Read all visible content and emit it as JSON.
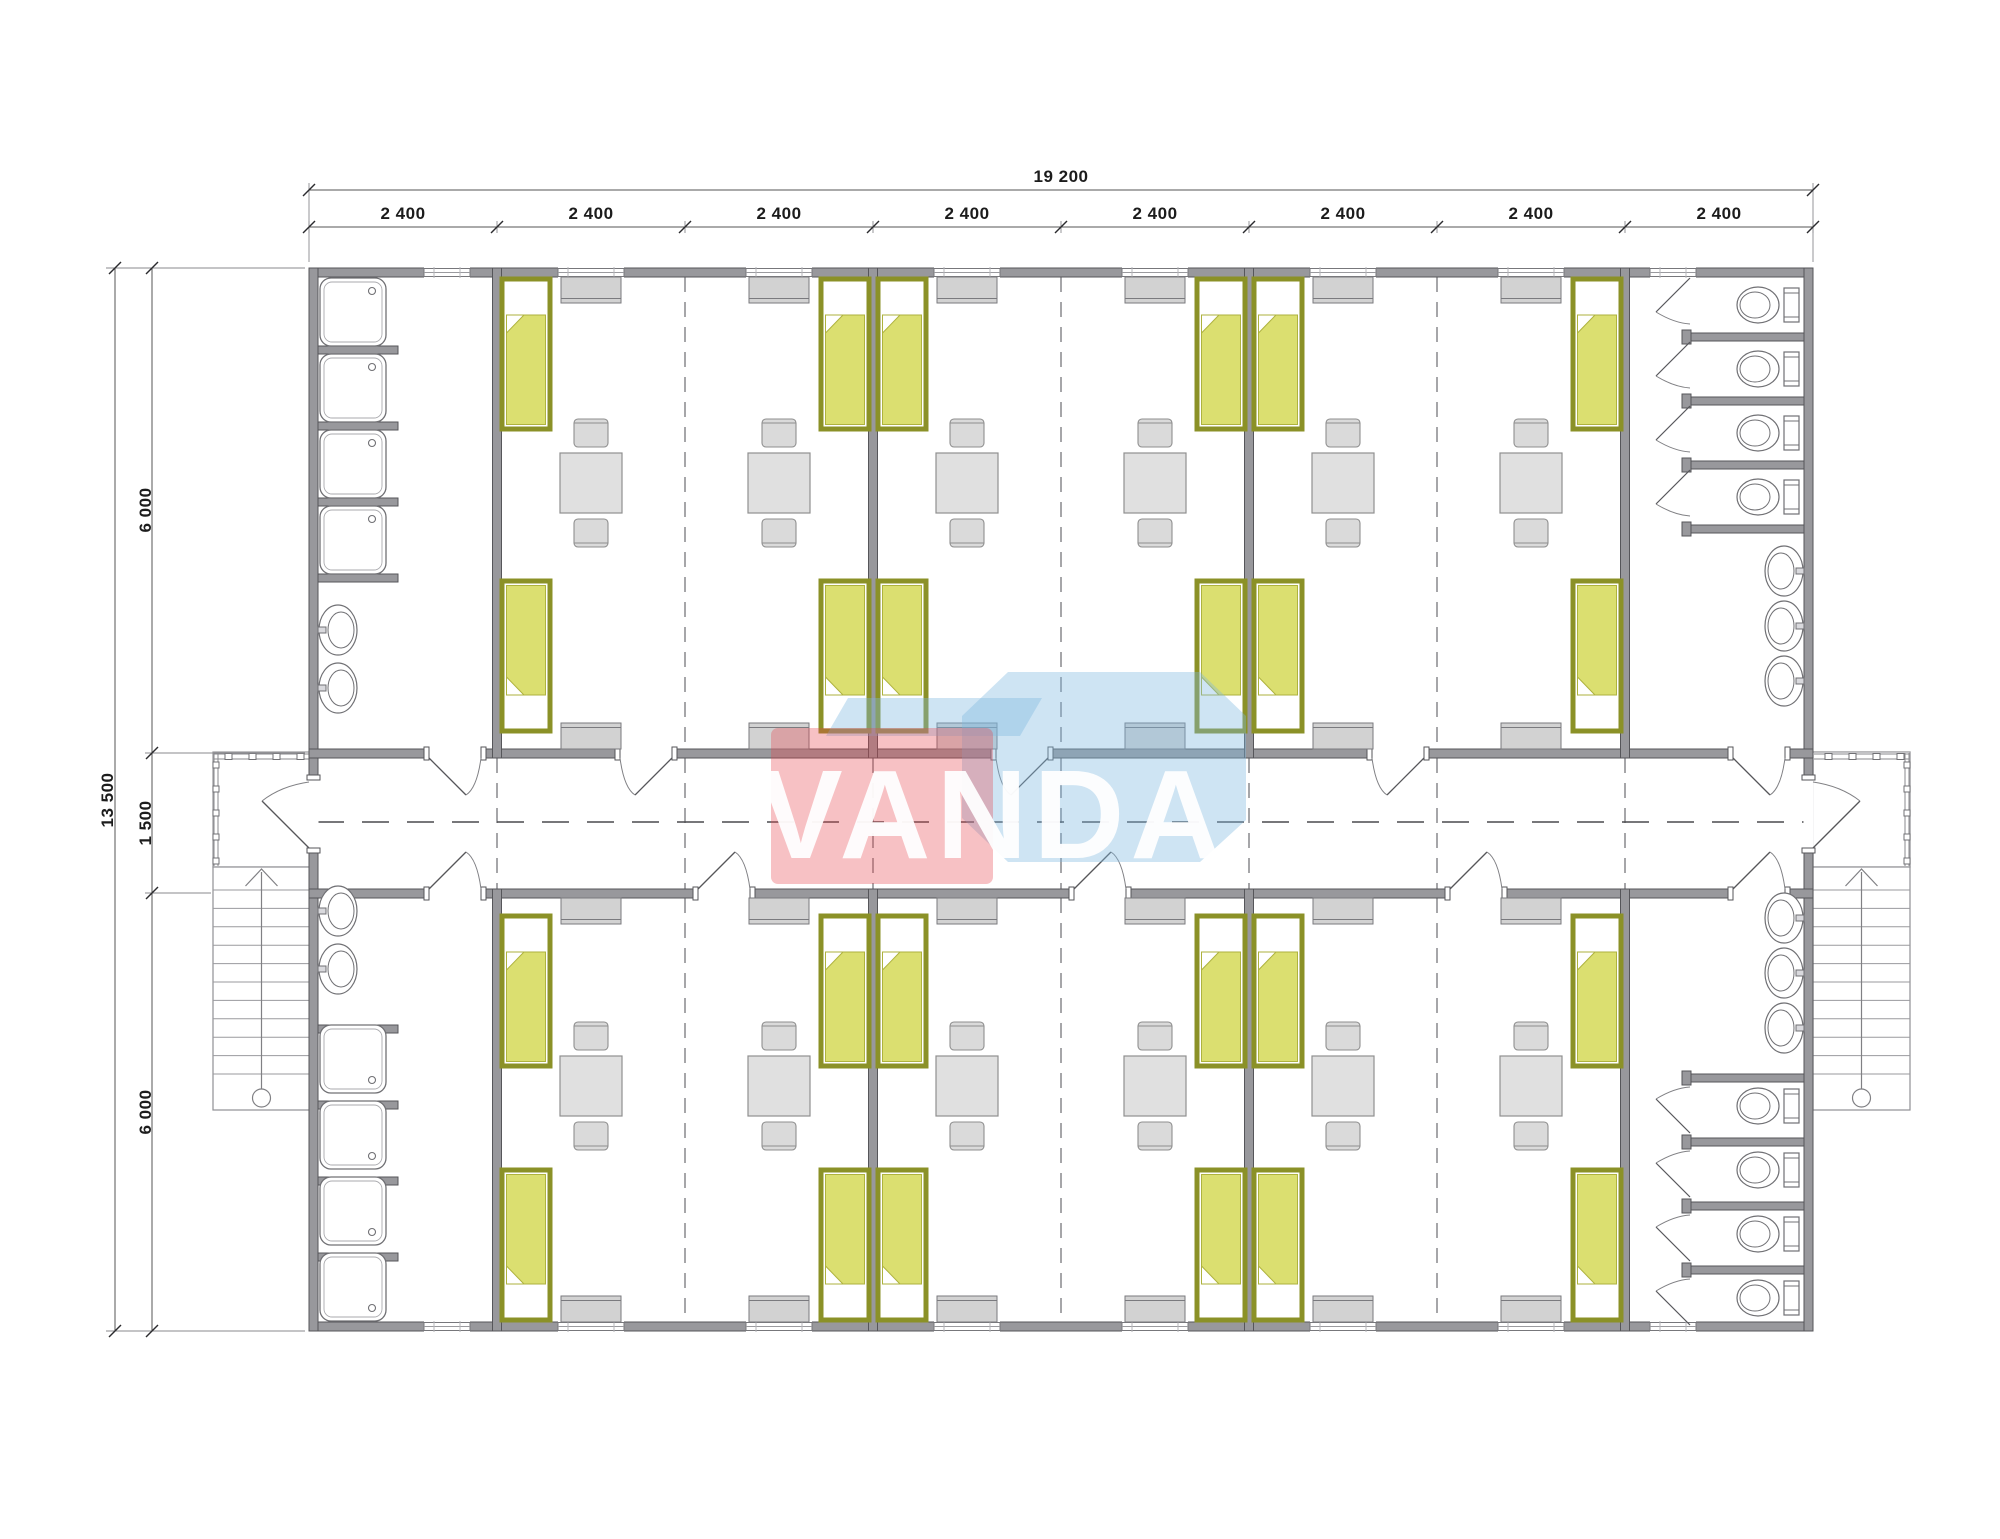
{
  "drawing": {
    "type": "architectural floor plan",
    "subject": "modular dormitory block, 8 container modules, central corridor",
    "module_count": 8
  },
  "dimensions": {
    "top_total": "19 200",
    "top_segments": [
      "2 400",
      "2 400",
      "2 400",
      "2 400",
      "2 400",
      "2 400",
      "2 400",
      "2 400"
    ],
    "left_total": "13 500",
    "left_segments": [
      "6 000",
      "1 500",
      "6 000"
    ]
  },
  "watermark": {
    "text": "VANDA"
  },
  "palette": {
    "wall": "#98989c",
    "wall_outline": "#56565a",
    "bed_frame": "#8b9127",
    "bed_blanket": "#dbdf70",
    "bed_blanket_line": "#aeb23e",
    "furniture": "#e0e0e0",
    "furniture_outline": "#8f8f8f",
    "cabinet": "#d2d2d2",
    "cabinet_outline": "#7a7a7e",
    "fixture_outline": "#707074",
    "axis_line": "#4a4a4e",
    "joint_line": "#77777b",
    "dim_line": "#555555",
    "thin_line": "#8a8a8e",
    "logo_red": "#e8424c",
    "logo_blue": "#7fb9e0",
    "logo_text": "#ffffff"
  },
  "rooms": {
    "dorm_rooms": {
      "count": 6,
      "beds_each": 4,
      "tables_each": 2,
      "chairs_per_table": 2,
      "wardrobes_each": 4,
      "windows_each": 2
    },
    "washroom_west_top": {
      "showers": 4,
      "sinks": 2
    },
    "washroom_west_bottom": {
      "showers": 4,
      "sinks": 2
    },
    "washroom_east_top": {
      "toilets": 4,
      "sinks": 3
    },
    "washroom_east_bottom": {
      "toilets": 4,
      "sinks": 3
    },
    "porches": 2,
    "stairs": 2
  }
}
